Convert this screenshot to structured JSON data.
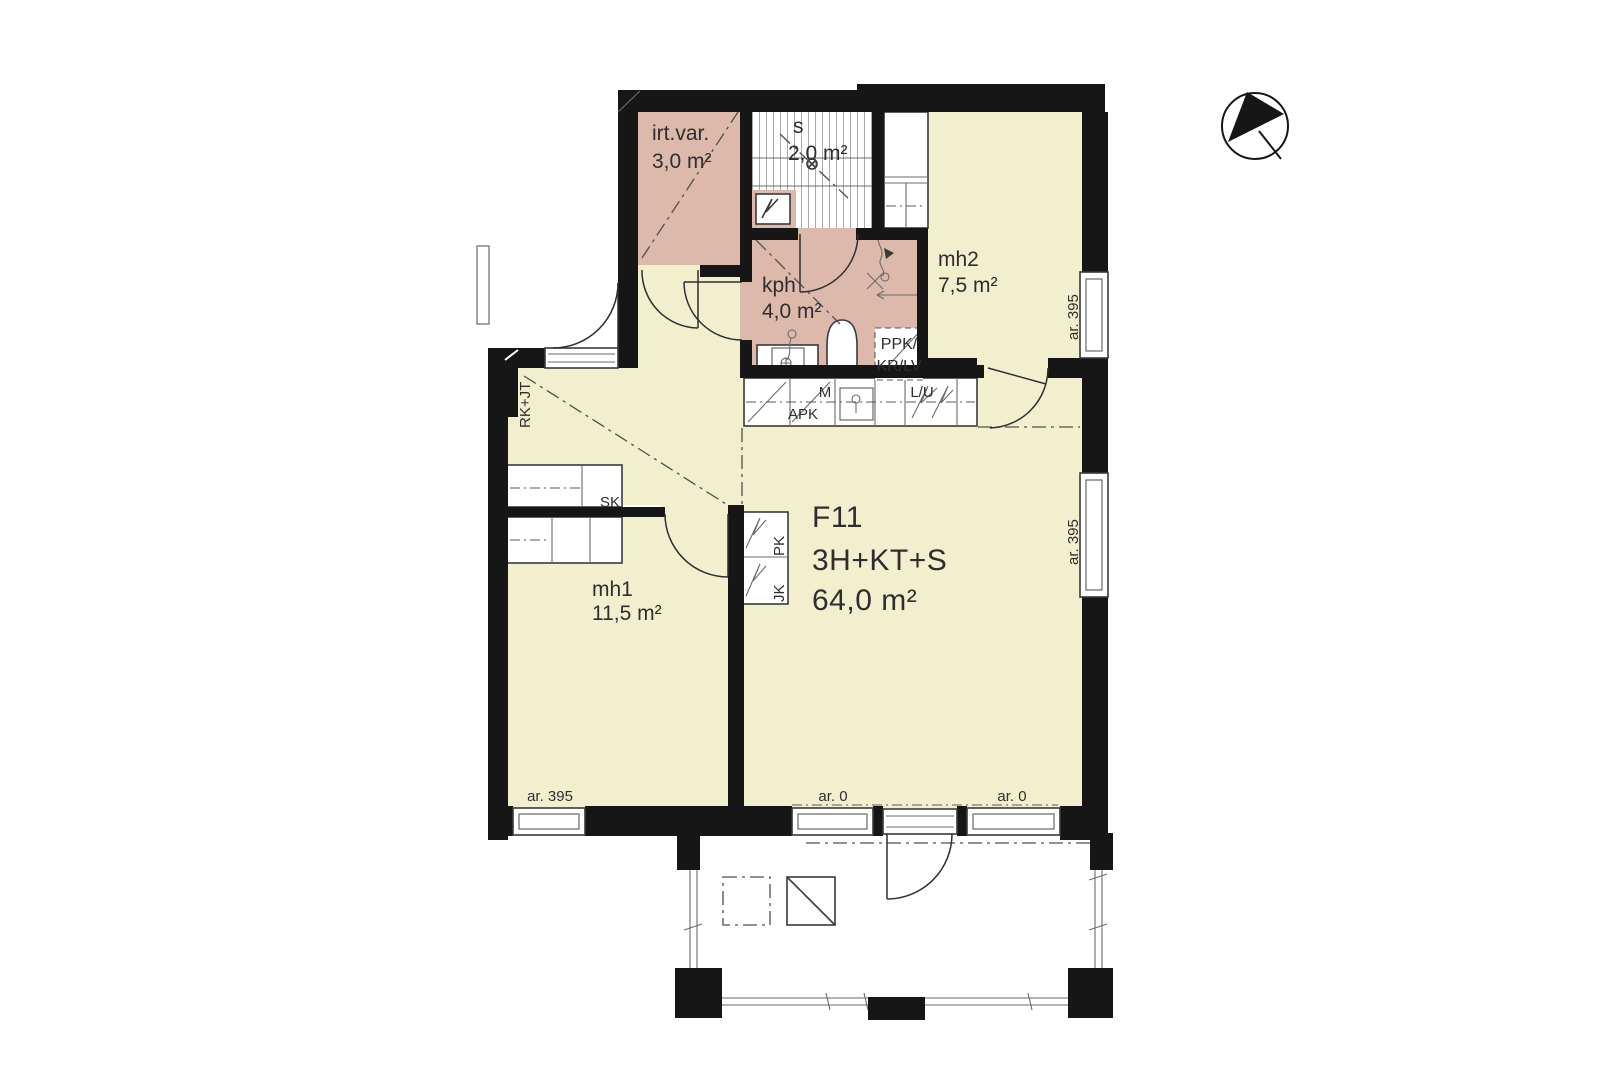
{
  "plan": {
    "apartment": {
      "code": "F11",
      "type": "3H+KT+S",
      "area": "64,0 m²"
    },
    "rooms": {
      "irtvar": {
        "name": "irt.var.",
        "area": "3,0 m²"
      },
      "sauna": {
        "name": "s",
        "area": "2,0 m²"
      },
      "kph": {
        "name": "kph",
        "area": "4,0 m²"
      },
      "mh2": {
        "name": "mh2",
        "area": "7,5 m²"
      },
      "mh1": {
        "name": "mh1",
        "area": "11,5 m²"
      }
    },
    "fixtures": {
      "apk": "APK",
      "m": "M",
      "lu": "L/U",
      "pk": "PK",
      "jk": "JK",
      "ppk_line1": "PPK/",
      "ppk_line2": "KR/LV",
      "rkjt": "RK+JT",
      "sk": "SK"
    },
    "dimensions": {
      "ar395": "ar. 395",
      "ar0": "ar. 0"
    }
  },
  "colors": {
    "dry_room_fill": "#f2efce",
    "wet_room_fill": "#dcb9ab",
    "wall": "#161616",
    "background": "#ffffff"
  }
}
